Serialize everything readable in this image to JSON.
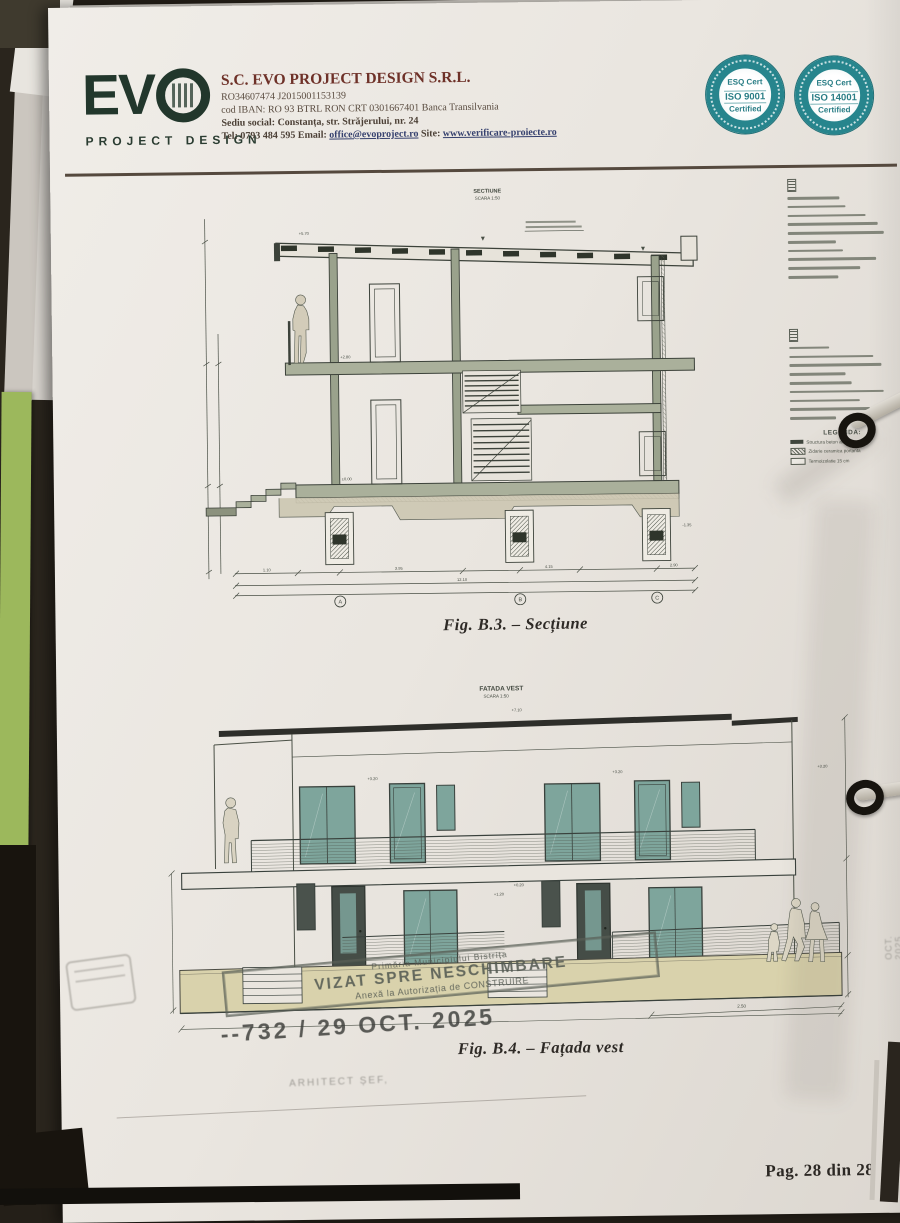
{
  "photo": {
    "paper": "#ece8e2",
    "background": "#241f18",
    "green_sheet": "#9cb85c",
    "accent_teal": "#27858d",
    "logo_green": "#22372c",
    "heading_red": "#6e3128",
    "stamp_gray": "#5a6058",
    "glass_teal": "#7ea59c",
    "base_beige": "#d9d2ac"
  },
  "header": {
    "logo_text": "EV",
    "logo_subtitle": "PROJECT DESIGN",
    "company_name": "S.C. EVO PROJECT DESIGN S.R.L.",
    "reg_line": "RO34607474    J2015001153139",
    "iban_line": "cod IBAN: RO 93 BTRL RON CRT 0301667401   Banca Transilvania",
    "address_line": "Sediu social: Constanța, str. Străjerului, nr. 24",
    "tel_label": "Tel:",
    "tel": "0793 484 595",
    "email_label": "Email:",
    "email": "office@evoproject.ro",
    "site_label": "Site:",
    "site": "www.verificare-proiecte.ro",
    "badges": [
      {
        "l1": "ESQ Cert",
        "l2": "ISO 9001",
        "l3": "Certified"
      },
      {
        "l1": "ESQ Cert",
        "l2": "ISO 14001",
        "l3": "Certified"
      }
    ]
  },
  "section": {
    "title": "SECTIUNE",
    "scale": "SCARA 1:50",
    "caption": "Fig. B.3. – Secțiune",
    "grid_labels": [
      "A",
      "B",
      "C"
    ],
    "levels": [
      "+5.70",
      "+2.80",
      "±0.00",
      "-1.35"
    ],
    "dims": [
      "1.10",
      "3.95",
      "4.15",
      "2.90"
    ],
    "dim_total": "12.10"
  },
  "sidebar": {
    "legend_title": "LEGENDA:",
    "legend_items": [
      {
        "label": "Structura beton armat"
      },
      {
        "label": "Zidarie ceramica portanta"
      },
      {
        "label": "Termoizolatie 15 cm"
      }
    ]
  },
  "facade": {
    "title": "FATADA VEST",
    "scale": "SCARA 1:50",
    "caption": "Fig. B.4. – Fațada vest",
    "levels": [
      "+7.10",
      "+3.20",
      "+1.20",
      "+0.20"
    ],
    "dims": [
      "2.50"
    ]
  },
  "stamps": {
    "municipal_top": "Primăria Municipiului Bistrița",
    "municipal_main": "VIZAT SPRE NESCHIMBARE",
    "municipal_sub": "Anexă la Autorizația de CONSTRUIRE",
    "registry": "--732 / 29 OCT. 2025",
    "architect": "ARHITECT ȘEF,",
    "side_date": "OCT. 2025"
  },
  "footer": {
    "page": "Pag. 28 din 28"
  }
}
